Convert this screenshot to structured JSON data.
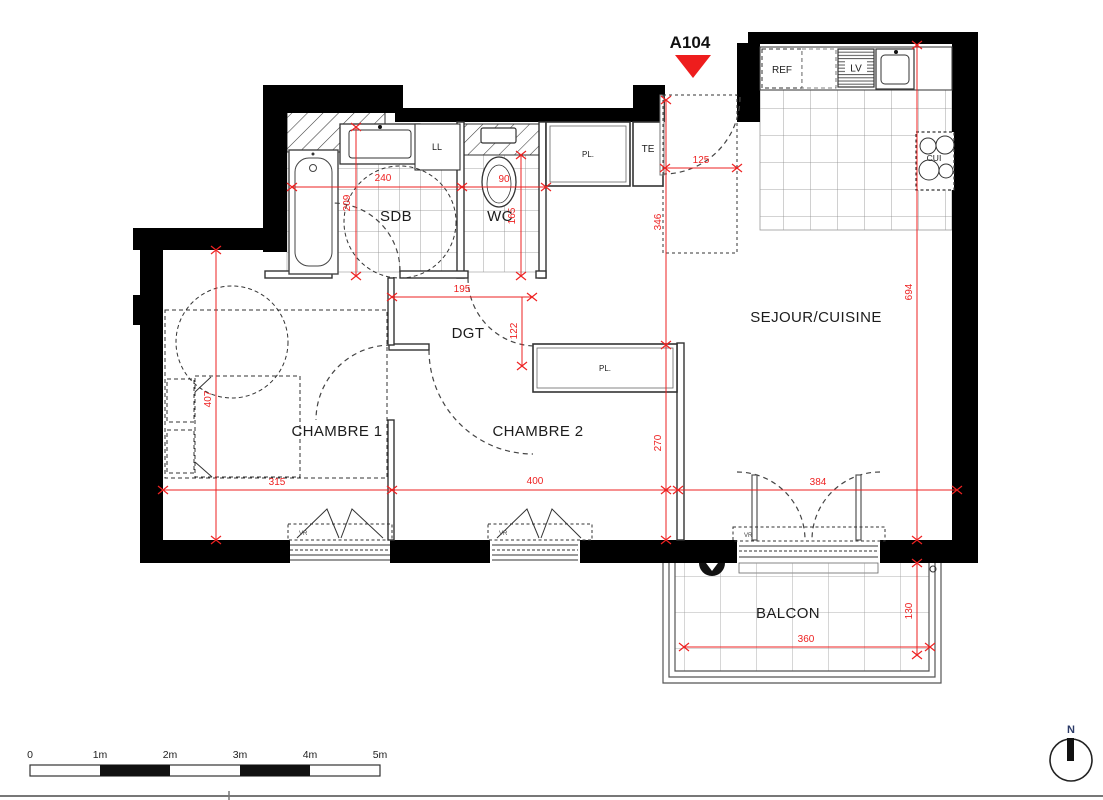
{
  "title": {
    "unit": "A104"
  },
  "rooms": {
    "sdb": "SDB",
    "wc": "WC",
    "dgt": "DGT",
    "chambre1": "CHAMBRE 1",
    "chambre2": "CHAMBRE 2",
    "sejour": "SEJOUR/CUISINE",
    "balcon": "BALCON"
  },
  "fixtures": {
    "ref": "REF",
    "lv": "LV",
    "cui": "CUI",
    "ll": "LL",
    "pl_hall": "PL.",
    "pl_chambre2": "PL.",
    "te": "TE",
    "vr": "VR"
  },
  "dimensions_cm": {
    "entrance_width": "125",
    "sdb_width": "240",
    "sdb_depth": "209",
    "wc_width": "90",
    "wc_depth": "165",
    "sdb_wc_width": "195",
    "dgt_depth": "122",
    "hall_depth": "346",
    "chambre2_depth": "270",
    "sejour_depth": "694",
    "chambre1_depth": "407",
    "chambre1_width": "315",
    "chambre2_width": "400",
    "sejour_width": "384",
    "balcon_width": "360",
    "balcon_depth": "130"
  },
  "scale_bar": {
    "ticks": [
      "0",
      "1m",
      "2m",
      "3m",
      "4m",
      "5m"
    ]
  },
  "compass": {
    "north": "N"
  },
  "colors": {
    "wall": "#000000",
    "dimension_red": "#ee2222",
    "marker_red": "#ee1d1d",
    "partition": "#333333",
    "tile_line": "#8a8a8a"
  }
}
